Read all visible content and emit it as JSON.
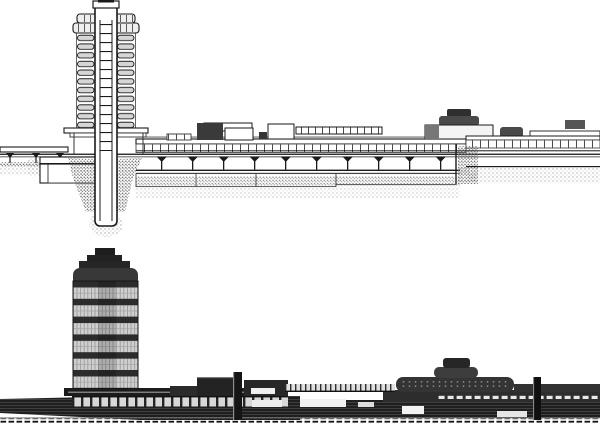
{
  "image": {
    "kind": "architectural-drawing",
    "subject": "Tower with attached long low building shown twice: cross-section drawing on top, dark rendered elevation below",
    "views": [
      {
        "id": "section",
        "position": "top",
        "style": "white line drawing with stippled earth and taproot foundation"
      },
      {
        "id": "elevation",
        "position": "bottom",
        "style": "dark toned rendering with banded glass tower and long podium wall"
      }
    ]
  },
  "metrics": {
    "section_tower_floor_slabs": 11,
    "section_core_rungs": 14,
    "elevation_tower_glass_bands": 6,
    "dendriform_columns": 10
  },
  "colors": {
    "paper": "#ffffff",
    "ink": "#1a1a1a",
    "ink_soft": "#4a4a4a",
    "shade_light": "#d6d6d6",
    "shade_mid": "#8a8a8a",
    "drum_gray": "#4a4a4a",
    "mass_dark": "#232323",
    "mass_mid": "#323232",
    "glass": "#cfcfcf",
    "stipple": "#9a9a9a",
    "stipple_dark": "#6a6a6a",
    "window_white": "#efefef"
  }
}
